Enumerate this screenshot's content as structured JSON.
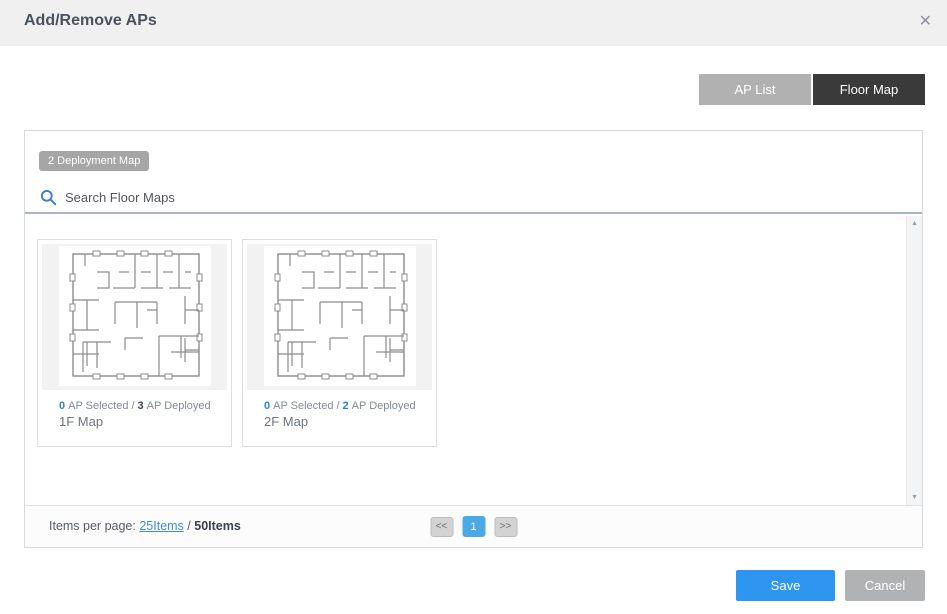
{
  "dialog": {
    "title": "Add/Remove APs"
  },
  "icons": {
    "close": "✕",
    "scroll_up": "▲",
    "scroll_down": "▼"
  },
  "tabs": [
    {
      "label": "AP List",
      "active": false
    },
    {
      "label": "Floor Map",
      "active": true
    }
  ],
  "panel": {
    "badge": "2 Deployment Map",
    "search_placeholder": "Search Floor Maps"
  },
  "cards": [
    {
      "selected_count": "0",
      "selected_label": "AP Selected",
      "separator": "/",
      "deployed_count": "3",
      "deployed_label": "AP Deployed",
      "name": "1F Map"
    },
    {
      "selected_count": "0",
      "selected_label": "AP Selected",
      "separator": "/",
      "deployed_count": "2",
      "deployed_label": "AP Deployed",
      "name": "2F Map"
    }
  ],
  "footer": {
    "items_per_page_label": "Items per page:",
    "per_page_link": "25Items",
    "separator": "/",
    "total_items": "50Items",
    "pagination": {
      "prev": "<<",
      "current": "1",
      "next": ">>"
    }
  },
  "actions": {
    "save": "Save",
    "cancel": "Cancel"
  },
  "colors": {
    "header_bg": "#f0f0f1",
    "tab_active_bg": "#3a3a3a",
    "tab_inactive_bg": "#b1b1b2",
    "badge_bg": "#a6a6a6",
    "search_icon_blue": "#3a7bd8",
    "search_underline": "#a8b4c4",
    "count_blue": "#2f7fe2",
    "count_dark": "#3c4454",
    "link_blue": "#3f8ee2",
    "pagination_active_bg": "#4ba9e3",
    "save_button_bg": "#2e96f0",
    "cancel_button_bg": "#b1b2b4"
  }
}
